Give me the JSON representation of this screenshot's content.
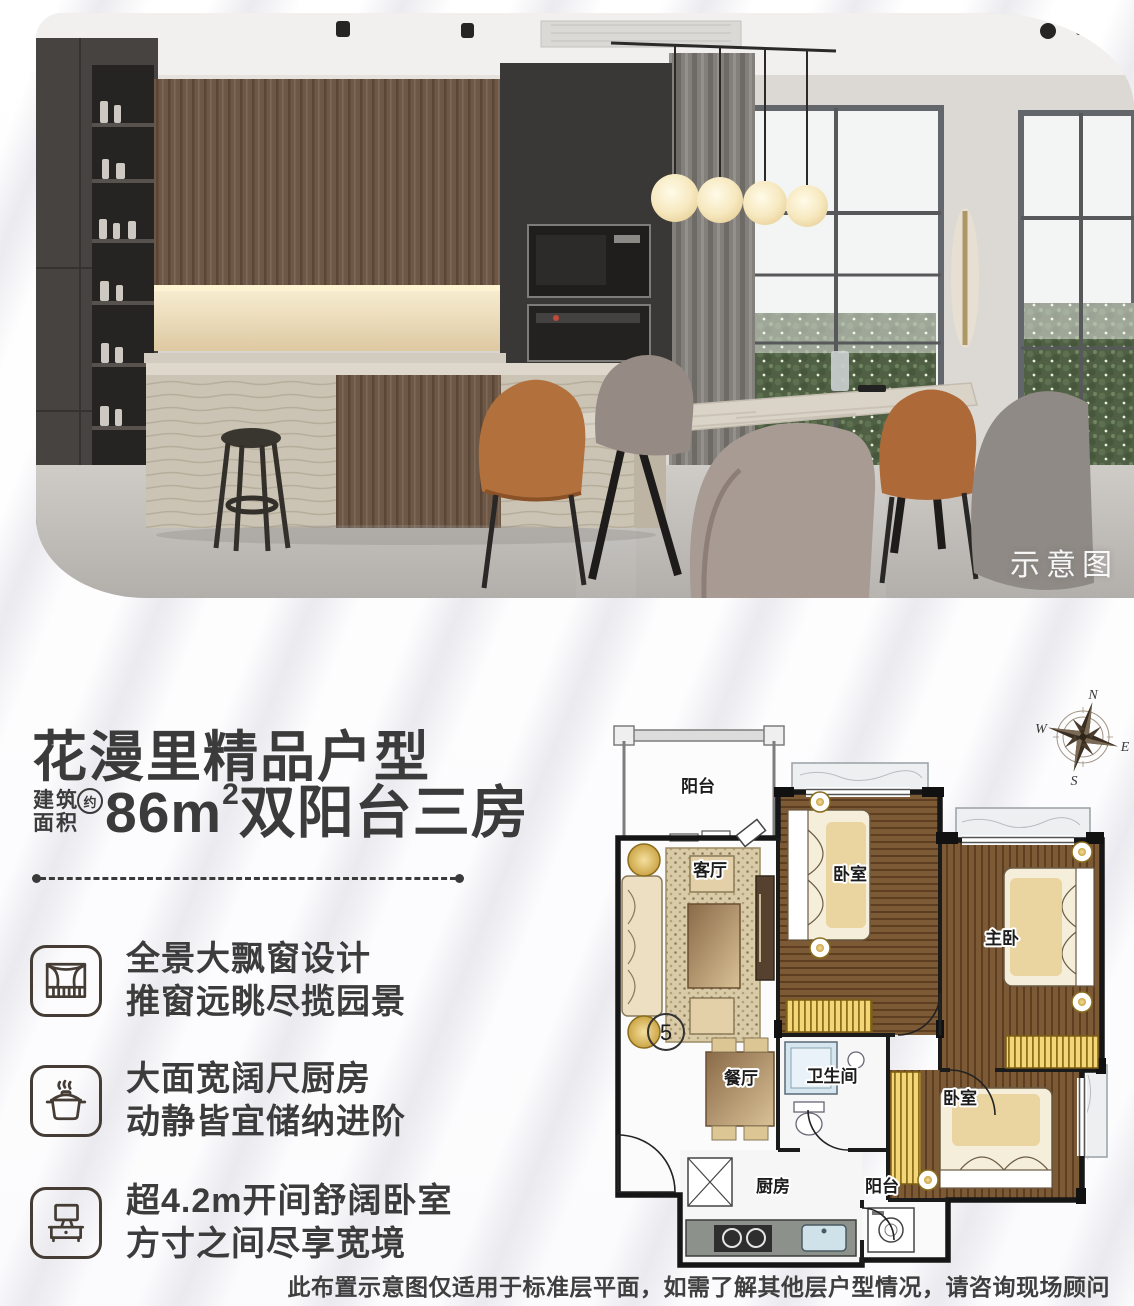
{
  "photo": {
    "badge": "示意图"
  },
  "headline": {
    "title": "花漫里精品户型",
    "area_prefix_line1": "建筑",
    "area_prefix_line2": "面积",
    "area_approx": "约",
    "area_value": "86",
    "area_unit_base": "m",
    "area_unit_sup": "2",
    "area_suffix": "双阳台三房"
  },
  "features": [
    {
      "icon": "window-curtain-icon",
      "line1": "全景大飘窗设计",
      "line2": "推窗远眺尽揽园景"
    },
    {
      "icon": "cooking-pot-icon",
      "line1": "大面宽阔尺厨房",
      "line2": "动静皆宜储纳进阶"
    },
    {
      "icon": "tv-stand-icon",
      "line1": "超4.2m开间舒阔卧室",
      "line2": "方寸之间尽享宽境"
    }
  ],
  "floorplan": {
    "unit_number": "5",
    "compass": {
      "n": "N",
      "e": "E",
      "s": "S",
      "w": "W"
    },
    "rooms": {
      "balcony_top": "阳台",
      "living": "客厅",
      "bedroom1": "卧室",
      "master": "主卧",
      "dining": "餐厅",
      "bathroom": "卫生间",
      "bedroom2": "卧室",
      "kitchen": "厨房",
      "balcony_bottom": "阳台"
    }
  },
  "disclaimer": "此布置示意图仅适用于标准层平面，如需了解其他层户型情况，请咨询现场顾问",
  "colors": {
    "text": "#3c3c3c",
    "plan_wood": "#7a5230",
    "plan_bay_window": "#f0d27a"
  }
}
